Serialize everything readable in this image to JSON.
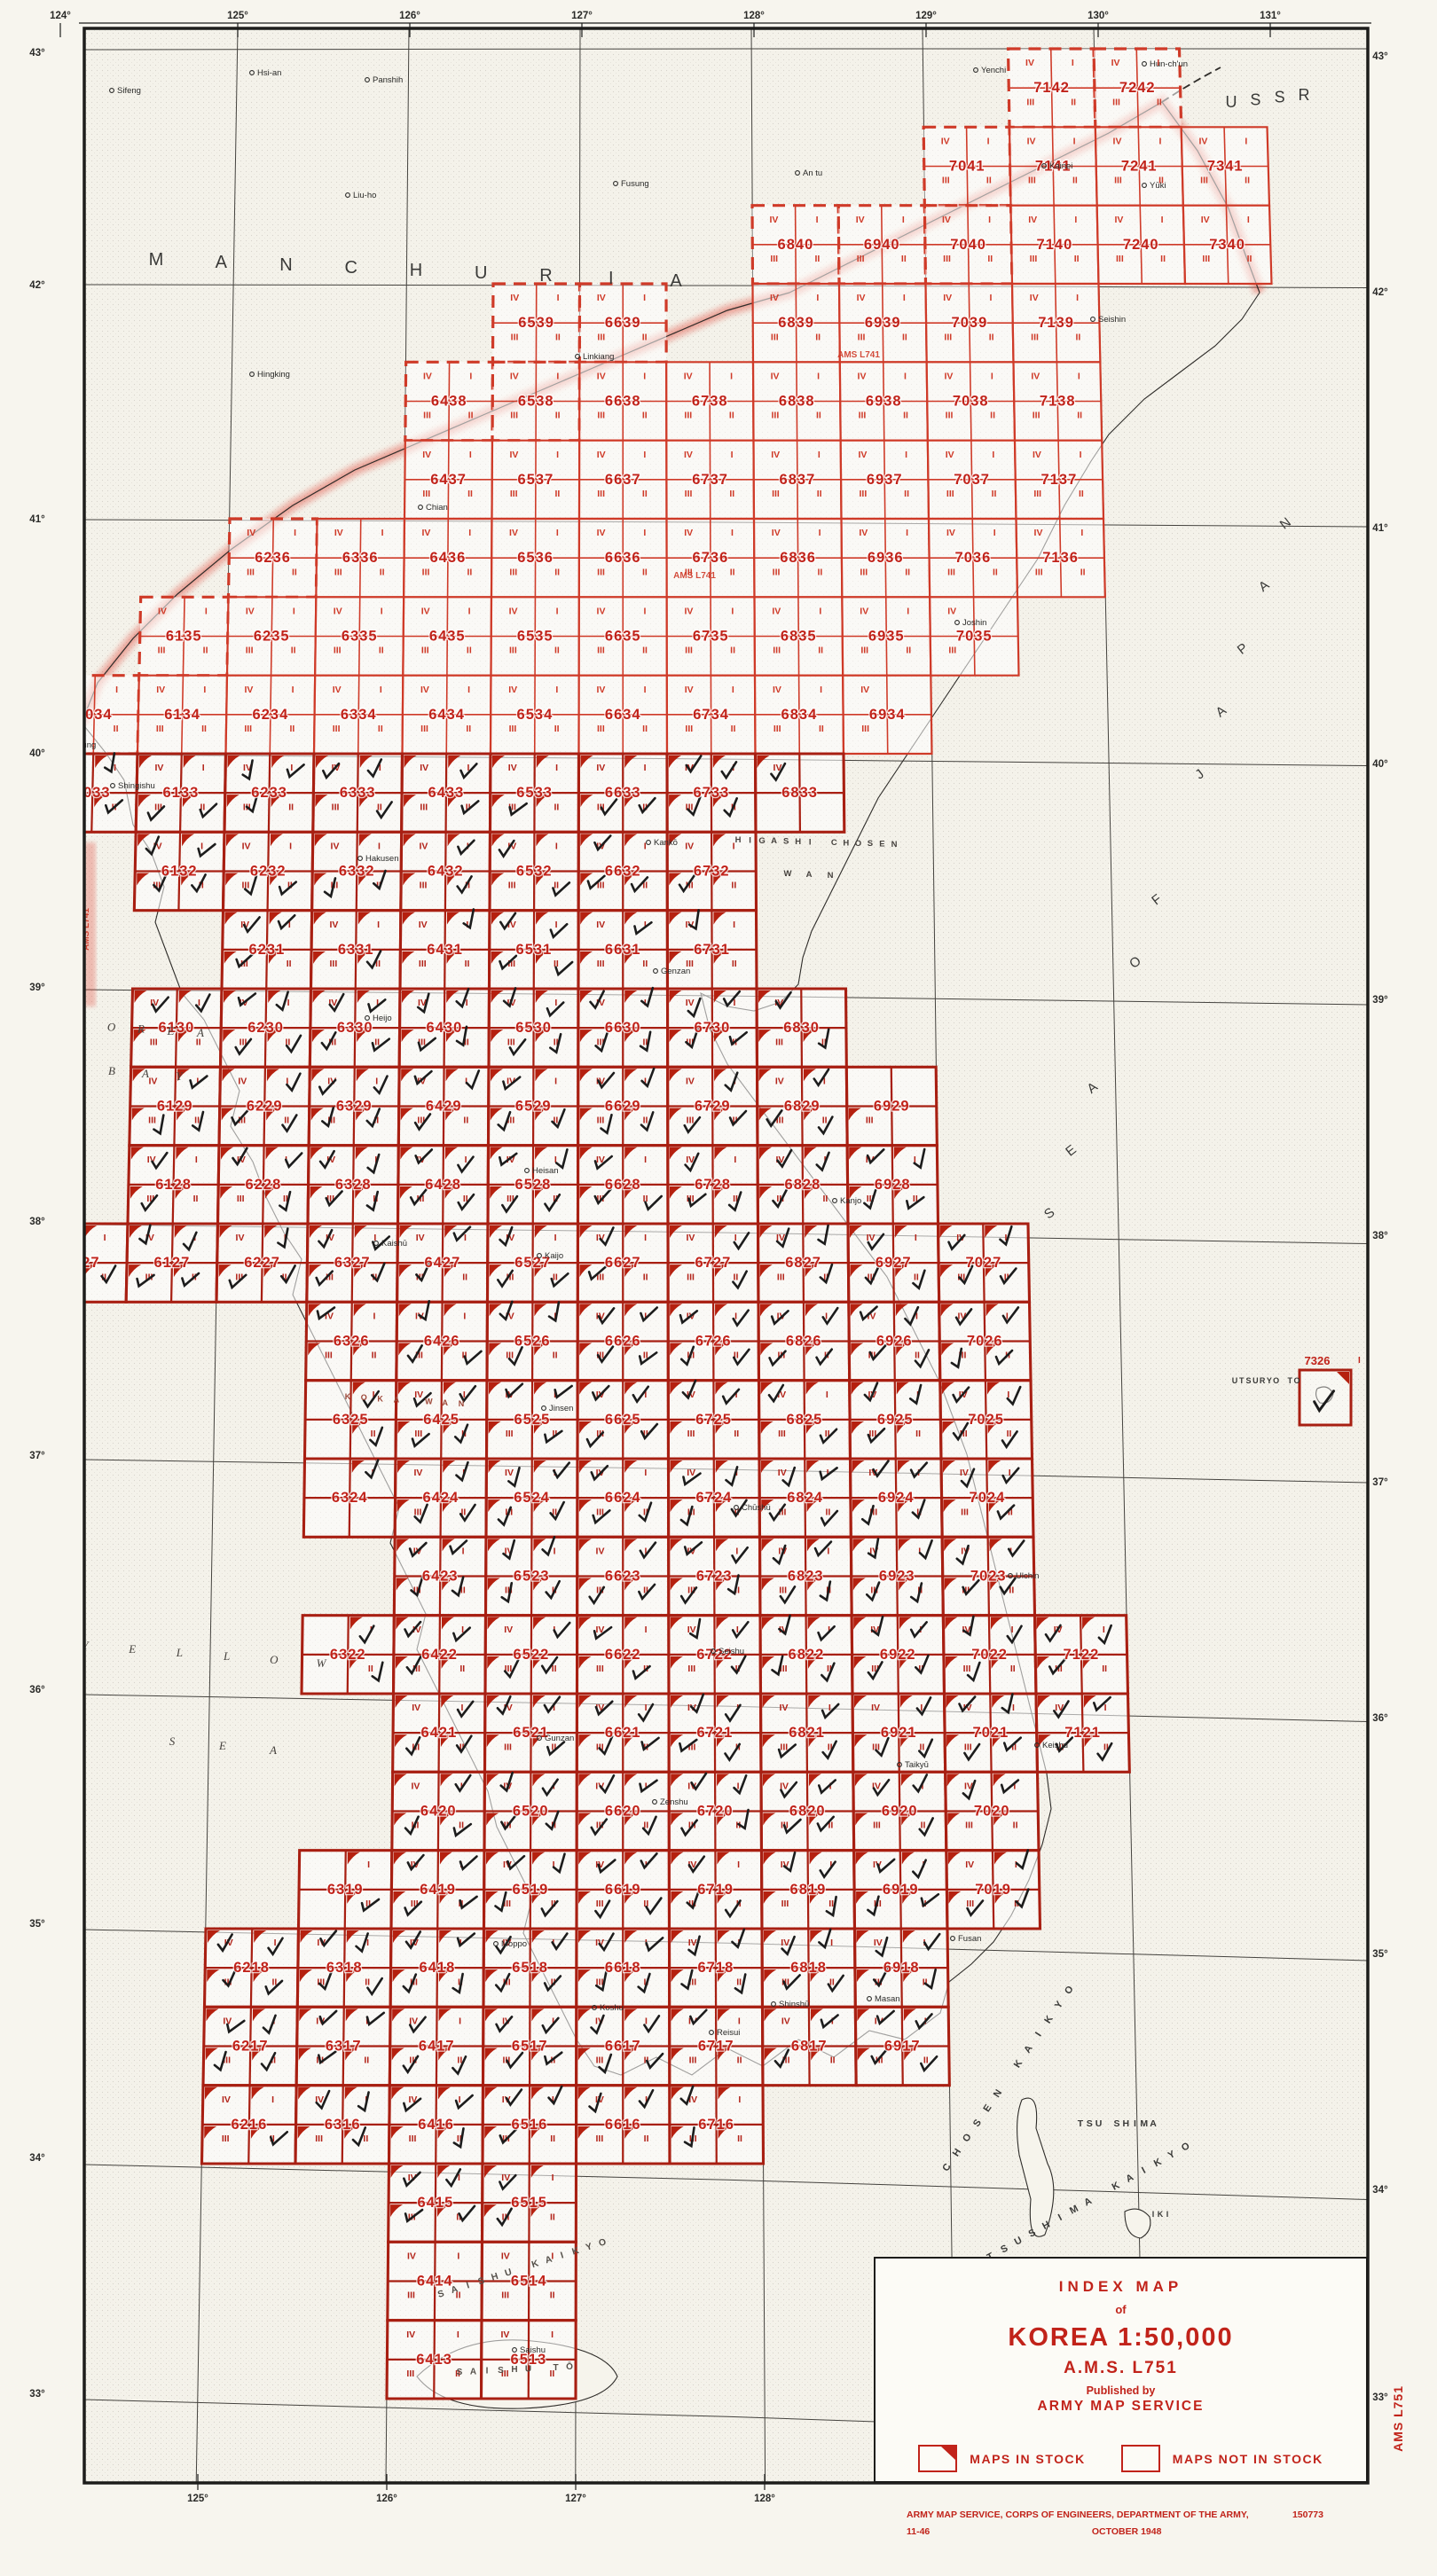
{
  "title_block": {
    "line1": "INDEX MAP",
    "line2": "of",
    "title": "KOREA 1:50,000",
    "series": "A.M.S. L751",
    "pub1": "Published by",
    "pub2": "ARMY MAP SERVICE",
    "legend_in_stock": "MAPS IN STOCK",
    "legend_not_in_stock": "MAPS NOT IN STOCK"
  },
  "credits": {
    "line1": "ARMY MAP SERVICE, CORPS OF ENGINEERS, DEPARTMENT OF THE ARMY,",
    "number": "150773",
    "date": "OCTOBER 1948",
    "edition": "11-46"
  },
  "margin_label": "AMS L751",
  "inline_series_labels": [
    {
      "t": "AMS L741",
      "x": 100,
      "y": 1048,
      "rot": -90
    },
    {
      "t": "AMS L741",
      "x": 783,
      "y": 652,
      "rot": 0
    },
    {
      "t": "AMS L741",
      "x": 968,
      "y": 403,
      "rot": 0
    }
  ],
  "graticule": {
    "top": [
      {
        "t": "124°",
        "x": 68
      },
      {
        "t": "125°",
        "x": 268
      },
      {
        "t": "126°",
        "x": 462
      },
      {
        "t": "127°",
        "x": 656
      },
      {
        "t": "128°",
        "x": 850
      },
      {
        "t": "129°",
        "x": 1044
      },
      {
        "t": "130°",
        "x": 1238
      },
      {
        "t": "131°",
        "x": 1432
      }
    ],
    "bottom": [
      {
        "t": "125°",
        "x": 223
      },
      {
        "t": "126°",
        "x": 436
      },
      {
        "t": "127°",
        "x": 649
      },
      {
        "t": "128°",
        "x": 862
      }
    ],
    "left": [
      {
        "t": "43°",
        "y": 60
      },
      {
        "t": "42°",
        "y": 322
      },
      {
        "t": "41°",
        "y": 586
      },
      {
        "t": "40°",
        "y": 850
      },
      {
        "t": "39°",
        "y": 1114
      },
      {
        "t": "38°",
        "y": 1378
      },
      {
        "t": "37°",
        "y": 1642
      },
      {
        "t": "36°",
        "y": 1906
      },
      {
        "t": "35°",
        "y": 2170
      },
      {
        "t": "34°",
        "y": 2434
      },
      {
        "t": "33°",
        "y": 2700
      }
    ],
    "right": [
      {
        "t": "43°",
        "y": 64
      },
      {
        "t": "42°",
        "y": 330
      },
      {
        "t": "41°",
        "y": 596
      },
      {
        "t": "40°",
        "y": 862
      },
      {
        "t": "39°",
        "y": 1128
      },
      {
        "t": "38°",
        "y": 1394
      },
      {
        "t": "37°",
        "y": 1672
      },
      {
        "t": "36°",
        "y": 1938
      },
      {
        "t": "35°",
        "y": 2204
      },
      {
        "t": "34°",
        "y": 2470
      },
      {
        "t": "33°",
        "y": 2704
      }
    ],
    "meridians": [
      125,
      126,
      127,
      128,
      129,
      130
    ],
    "parallels": [
      33,
      34,
      35,
      36,
      37,
      38,
      39,
      40,
      41,
      42,
      43
    ]
  },
  "regions": [
    {
      "text": "MANCHURIA",
      "x1": 176,
      "y1": 299,
      "x2": 762,
      "y2": 323,
      "size": 20,
      "rot": 0,
      "color": "#3a3a38",
      "spread": true
    },
    {
      "text": "USSR",
      "x1": 1388,
      "y1": 121,
      "x2": 1470,
      "y2": 113,
      "size": 18,
      "rot": 0,
      "color": "#3a3a38",
      "spread": true
    }
  ],
  "sea_labels": [
    {
      "text": "SEA OF JAPAN",
      "x1": 1186,
      "y1": 1372,
      "x2": 1452,
      "y2": 594,
      "size": 15,
      "rot": -38,
      "color": "#3a3a38"
    },
    {
      "text": "KOREA",
      "x1": 92,
      "y1": 1160,
      "x2": 226,
      "y2": 1169,
      "size": 13,
      "rot": 0,
      "color": "#46423e",
      "italic": true
    },
    {
      "text": "BAY",
      "x1": 126,
      "y1": 1212,
      "x2": 202,
      "y2": 1218,
      "size": 13,
      "rot": 0,
      "color": "#46423e",
      "italic": true
    },
    {
      "text": "YELLOW",
      "x1": 96,
      "y1": 1860,
      "x2": 362,
      "y2": 1880,
      "size": 13,
      "rot": 0,
      "color": "#46423e",
      "italic": true
    },
    {
      "text": "SEA",
      "x1": 194,
      "y1": 1968,
      "x2": 308,
      "y2": 1978,
      "size": 13,
      "rot": 0,
      "color": "#46423e",
      "italic": true
    },
    {
      "text": "HIGASHI CHOSEN",
      "x1": 832,
      "y1": 950,
      "x2": 1008,
      "y2": 955,
      "size": 9.5,
      "rot": 0,
      "color": "#46423e"
    },
    {
      "text": "WAN",
      "x1": 888,
      "y1": 988,
      "x2": 936,
      "y2": 990,
      "size": 9.5,
      "rot": 0,
      "color": "#46423e"
    },
    {
      "text": "KOKA WAN",
      "x1": 392,
      "y1": 1578,
      "x2": 520,
      "y2": 1586,
      "size": 9,
      "rot": 0,
      "color": "#9c4536"
    },
    {
      "text": "CHOSEN KAIKYO",
      "x1": 1070,
      "y1": 2446,
      "x2": 1208,
      "y2": 2246,
      "size": 11,
      "rot": -57,
      "color": "#3a3a38"
    },
    {
      "text": "TSUSHIMA KAIKYO",
      "x1": 1118,
      "y1": 2548,
      "x2": 1338,
      "y2": 2424,
      "size": 11,
      "rot": -28,
      "color": "#3a3a38"
    },
    {
      "text": "SAISHU KAIKYO",
      "x1": 498,
      "y1": 2590,
      "x2": 680,
      "y2": 2532,
      "size": 10.5,
      "rot": -17,
      "color": "#55504a"
    },
    {
      "text": "SAISHU TŌ",
      "x1": 518,
      "y1": 2678,
      "x2": 642,
      "y2": 2672,
      "size": 10,
      "rot": 0,
      "color": "#55504a"
    },
    {
      "text": "TSU SHIMA",
      "x1": 1218,
      "y1": 2398,
      "x2": 1300,
      "y2": 2398,
      "size": 10.5,
      "rot": 0,
      "color": "#3a3a38"
    },
    {
      "text": "UTSURYO TO",
      "x1": 1392,
      "y1": 1560,
      "x2": 1462,
      "y2": 1560,
      "size": 9,
      "rot": 0,
      "color": "#3a3a38"
    },
    {
      "text": "IKI",
      "x1": 1300,
      "y1": 2500,
      "x2": 1316,
      "y2": 2500,
      "size": 9,
      "rot": 0,
      "color": "#3a3a38"
    }
  ],
  "cities": [
    [
      290,
      80,
      "Hsi-an"
    ],
    [
      132,
      100,
      "Sifeng"
    ],
    [
      420,
      88,
      "Panshih"
    ],
    [
      398,
      218,
      "Liu-ho"
    ],
    [
      700,
      205,
      "Fusung"
    ],
    [
      905,
      193,
      "An tu"
    ],
    [
      1106,
      77,
      "Yenchi"
    ],
    [
      1296,
      70,
      "Hun-ch'un"
    ],
    [
      290,
      420,
      "Hingking"
    ],
    [
      657,
      400,
      "Linkiang"
    ],
    [
      480,
      570,
      "Chian"
    ],
    [
      1183,
      185,
      "Kainei"
    ],
    [
      1296,
      207,
      "Yūki"
    ],
    [
      1238,
      358,
      "Seishin"
    ],
    [
      1085,
      700,
      "Joshin"
    ],
    [
      75,
      838,
      "An-tung"
    ],
    [
      133,
      884,
      "Shingishu"
    ],
    [
      412,
      966,
      "Hakusen"
    ],
    [
      420,
      1146,
      "Heijo"
    ],
    [
      600,
      1318,
      "Heisan"
    ],
    [
      737,
      948,
      "Kankō"
    ],
    [
      745,
      1093,
      "Genzan"
    ],
    [
      430,
      1400,
      "Kaishū"
    ],
    [
      614,
      1414,
      "Kaijo"
    ],
    [
      619,
      1586,
      "Jinsen"
    ],
    [
      947,
      1352,
      "Kanjo"
    ],
    [
      836,
      1698,
      "Chūshū"
    ],
    [
      810,
      1860,
      "Seishu"
    ],
    [
      614,
      1958,
      "Gunzan"
    ],
    [
      744,
      2030,
      "Zenshu"
    ],
    [
      1175,
      1966,
      "Keishu"
    ],
    [
      1020,
      1988,
      "Taikyū"
    ],
    [
      1145,
      1775,
      "Ulchin"
    ],
    [
      676,
      2262,
      "Koshu"
    ],
    [
      878,
      2258,
      "Shinshū"
    ],
    [
      986,
      2252,
      "Masan"
    ],
    [
      1080,
      2184,
      "Fusan"
    ],
    [
      565,
      2190,
      "Moppo"
    ],
    [
      808,
      2290,
      "Reisui"
    ],
    [
      586,
      2648,
      "Saishu"
    ]
  ],
  "cells": [
    "7142*",
    "7242*",
    "7041*",
    "7141",
    "7241",
    "7341",
    "6840*",
    "6940*",
    "7040*",
    "7140",
    "7240",
    "7340",
    "6539*",
    "6639*",
    "6839",
    "6939",
    "7039",
    "7139",
    "6438*",
    "6538*",
    "6638",
    "6738",
    "6838",
    "6938",
    "7038",
    "7138",
    "6437",
    "6537",
    "6637",
    "6737",
    "6837",
    "6937",
    "7037",
    "7137",
    "6236*",
    "6336",
    "6436",
    "6536",
    "6636",
    "6736",
    "6836",
    "6936",
    "7036",
    "7136",
    "6135*",
    "6235",
    "6335",
    "6435",
    "6535",
    "6635",
    "6735",
    "6835",
    "6935",
    "7035",
    "6034*",
    "6134",
    "6234",
    "6334",
    "6434",
    "6534",
    "6634",
    "6734",
    "6834",
    "6934",
    "6033",
    "6133",
    "6233",
    "6333",
    "6433",
    "6533",
    "6633",
    "6733",
    "6833",
    "6132",
    "6232",
    "6332",
    "6432",
    "6532",
    "6632",
    "6732",
    "6231",
    "6331",
    "6431",
    "6531",
    "6631",
    "6731",
    "6130",
    "6230",
    "6330",
    "6430",
    "6530",
    "6630",
    "6730",
    "6830",
    "6129",
    "6229",
    "6329",
    "6429",
    "6529",
    "6629",
    "6729",
    "6829",
    "6929",
    "6128",
    "6228",
    "6328",
    "6428",
    "6528",
    "6628",
    "6728",
    "6828",
    "6928",
    "6027",
    "6127",
    "6227",
    "6327",
    "6427",
    "6527",
    "6627",
    "6727",
    "6827",
    "6927",
    "7027",
    "6326",
    "6426",
    "6526",
    "6626",
    "6726",
    "6826",
    "6926",
    "7026",
    "6325",
    "6425",
    "6525",
    "6625",
    "6725",
    "6825",
    "6925",
    "7025",
    "6324",
    "6424",
    "6524",
    "6624",
    "6724",
    "6824",
    "6924",
    "7024",
    "6423",
    "6523",
    "6623",
    "6723",
    "6823",
    "6923",
    "7023",
    "6322",
    "6422",
    "6522",
    "6622",
    "6722",
    "6822",
    "6922",
    "7022",
    "7122",
    "6421",
    "6521",
    "6621",
    "6721",
    "6821",
    "6921",
    "7021",
    "7121",
    "6420",
    "6520",
    "6620",
    "6720",
    "6820",
    "6920",
    "7020",
    "6319",
    "6419",
    "6519",
    "6619",
    "6719",
    "6819",
    "6919",
    "7019",
    "6218",
    "6318",
    "6418",
    "6518",
    "6618",
    "6718",
    "6818",
    "6918",
    "6217",
    "6317",
    "6417",
    "6517",
    "6617",
    "6717",
    "6817",
    "6917",
    "6216",
    "6316",
    "6416",
    "6516",
    "6616",
    "6716",
    "6415",
    "6515",
    "6414",
    "6514",
    "6413",
    "6513"
  ],
  "island_cell": {
    "n": "7326",
    "x": 1465,
    "y": 1545,
    "w": 58,
    "h": 62,
    "quad": "I"
  },
  "partial_quads": {
    "7035": "IV,III",
    "6830": "IV,III,II",
    "6929": "III",
    "6934": "IV,III",
    "6833": "IV",
    "6325": "I,II",
    "6324": "I",
    "6322": "I,II",
    "6319": "I,II",
    "6027": "I,III,II"
  },
  "quad_order": [
    "IV",
    "I",
    "III",
    "II"
  ],
  "stock_rows": {
    "min": 15,
    "max": 33
  },
  "colors": {
    "grid_north": "#cf3a28",
    "grid_south": "#a81f12",
    "number": "#c1231a",
    "corner": "#b5200f",
    "hatch": "#e04030",
    "frame": "#1d1d1b",
    "ink": "#2a2a28",
    "paper": "#f7f5ee",
    "sea_dot": "#b9b6ac"
  },
  "boundary": [
    [
      92,
      815
    ],
    [
      110,
      770
    ],
    [
      150,
      720
    ],
    [
      200,
      670
    ],
    [
      260,
      620
    ],
    [
      330,
      570
    ],
    [
      400,
      530
    ],
    [
      470,
      500
    ],
    [
      540,
      470
    ],
    [
      610,
      440
    ],
    [
      680,
      410
    ],
    [
      750,
      380
    ],
    [
      820,
      350
    ],
    [
      890,
      330
    ],
    [
      950,
      300
    ],
    [
      1010,
      270
    ],
    [
      1070,
      240
    ],
    [
      1130,
      210
    ],
    [
      1190,
      180
    ],
    [
      1250,
      150
    ],
    [
      1310,
      115
    ],
    [
      1350,
      170
    ],
    [
      1385,
      235
    ],
    [
      1405,
      290
    ],
    [
      1420,
      330
    ]
  ],
  "coast": [
    [
      92,
      815
    ],
    [
      120,
      850
    ],
    [
      140,
      880
    ],
    [
      150,
      930
    ],
    [
      170,
      960
    ],
    [
      185,
      1000
    ],
    [
      175,
      1040
    ],
    [
      190,
      1080
    ],
    [
      205,
      1120
    ],
    [
      230,
      1150
    ],
    [
      250,
      1190
    ],
    [
      270,
      1230
    ],
    [
      260,
      1270
    ],
    [
      285,
      1310
    ],
    [
      300,
      1350
    ],
    [
      320,
      1390
    ],
    [
      340,
      1420
    ],
    [
      330,
      1460
    ],
    [
      350,
      1500
    ],
    [
      370,
      1540
    ],
    [
      390,
      1580
    ],
    [
      410,
      1620
    ],
    [
      430,
      1660
    ],
    [
      450,
      1700
    ],
    [
      440,
      1740
    ],
    [
      460,
      1780
    ],
    [
      480,
      1820
    ],
    [
      470,
      1860
    ],
    [
      490,
      1900
    ],
    [
      510,
      1940
    ],
    [
      530,
      1980
    ],
    [
      550,
      2020
    ],
    [
      560,
      2060
    ],
    [
      580,
      2100
    ],
    [
      600,
      2140
    ],
    [
      590,
      2180
    ],
    [
      610,
      2220
    ],
    [
      630,
      2260
    ],
    [
      650,
      2300
    ],
    [
      670,
      2330
    ],
    [
      700,
      2340
    ],
    [
      740,
      2320
    ],
    [
      780,
      2340
    ],
    [
      820,
      2310
    ],
    [
      860,
      2330
    ],
    [
      900,
      2300
    ],
    [
      940,
      2320
    ],
    [
      980,
      2290
    ],
    [
      1020,
      2300
    ],
    [
      1060,
      2270
    ],
    [
      1070,
      2235
    ],
    [
      1095,
      2215
    ],
    [
      1120,
      2190
    ],
    [
      1140,
      2160
    ],
    [
      1160,
      2120
    ],
    [
      1175,
      2080
    ],
    [
      1185,
      2040
    ],
    [
      1180,
      2000
    ],
    [
      1170,
      1960
    ],
    [
      1160,
      1920
    ],
    [
      1150,
      1880
    ],
    [
      1140,
      1840
    ],
    [
      1130,
      1800
    ],
    [
      1120,
      1760
    ],
    [
      1110,
      1720
    ],
    [
      1100,
      1680
    ],
    [
      1090,
      1640
    ],
    [
      1075,
      1600
    ],
    [
      1060,
      1560
    ],
    [
      1040,
      1520
    ],
    [
      1020,
      1480
    ],
    [
      1000,
      1440
    ],
    [
      970,
      1400
    ],
    [
      940,
      1360
    ],
    [
      910,
      1320
    ],
    [
      880,
      1280
    ],
    [
      850,
      1240
    ],
    [
      820,
      1200
    ],
    [
      800,
      1160
    ],
    [
      790,
      1120
    ],
    [
      800,
      1125
    ],
    [
      820,
      1135
    ],
    [
      850,
      1140
    ],
    [
      880,
      1130
    ],
    [
      900,
      1110
    ],
    [
      905,
      1080
    ],
    [
      915,
      1050
    ],
    [
      930,
      1020
    ],
    [
      945,
      990
    ],
    [
      960,
      960
    ],
    [
      975,
      930
    ],
    [
      990,
      900
    ],
    [
      1010,
      870
    ],
    [
      1030,
      840
    ],
    [
      1050,
      810
    ],
    [
      1070,
      780
    ],
    [
      1090,
      750
    ],
    [
      1110,
      720
    ],
    [
      1130,
      690
    ],
    [
      1150,
      660
    ],
    [
      1170,
      630
    ],
    [
      1185,
      600
    ],
    [
      1200,
      570
    ],
    [
      1215,
      545
    ],
    [
      1230,
      520
    ],
    [
      1250,
      490
    ],
    [
      1270,
      470
    ],
    [
      1290,
      450
    ],
    [
      1330,
      420
    ],
    [
      1370,
      390
    ],
    [
      1400,
      360
    ],
    [
      1420,
      330
    ]
  ]
}
